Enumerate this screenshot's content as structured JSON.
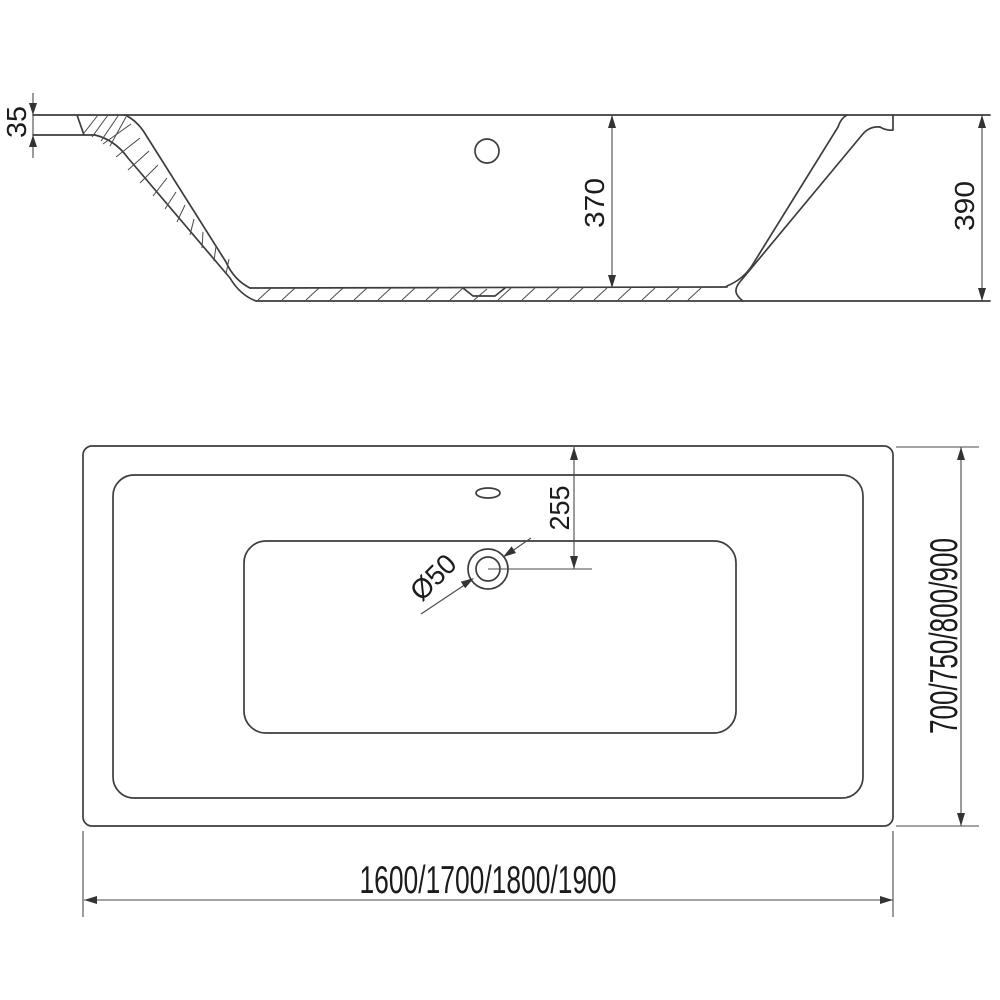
{
  "drawing_title": "bathtub-dimensional-drawing",
  "colors": {
    "background": "#ffffff",
    "object_line": "#3d3d3d",
    "dimension_line": "#4a4a4a",
    "text": "#1b1b1b"
  },
  "section_view": {
    "rim_thickness": "35",
    "inner_depth": "370",
    "total_height": "390"
  },
  "plan_view": {
    "drain_offset": "255",
    "drain_diameter": "Ø50",
    "length_options": "1600/1700/1800/1900",
    "width_options": "700/750/800/900"
  }
}
